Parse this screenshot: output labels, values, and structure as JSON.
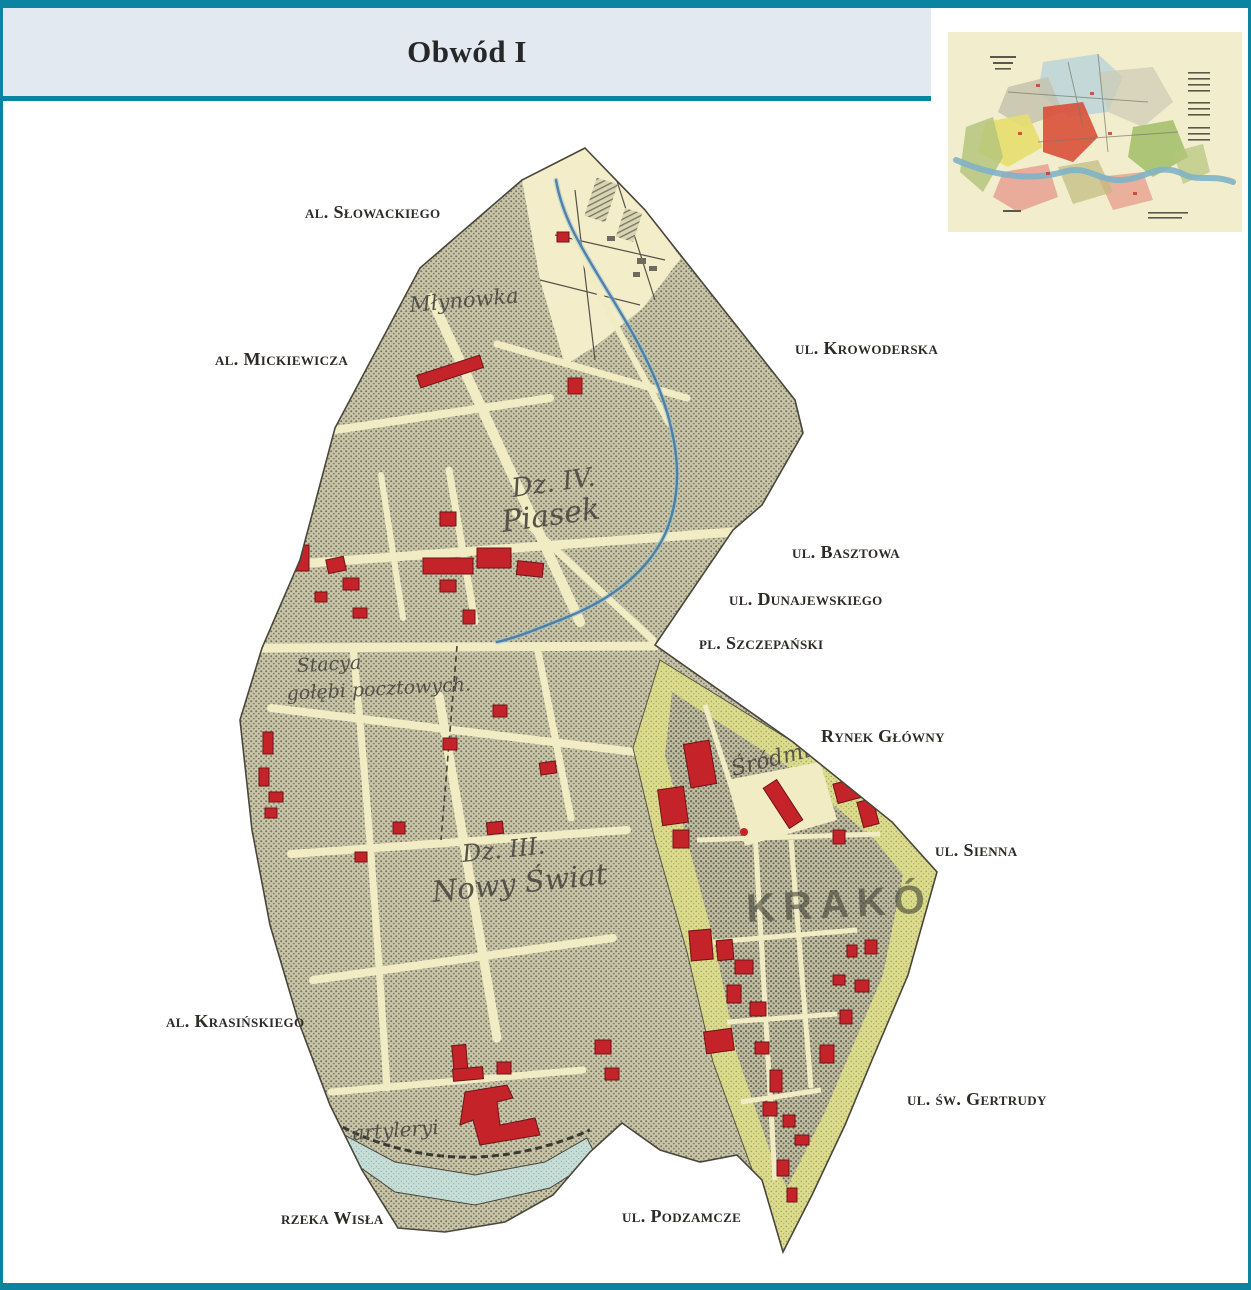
{
  "header": {
    "title": "Obwód I"
  },
  "street_labels": [
    {
      "id": "al-slowackiego",
      "text": "al. Słowackiego"
    },
    {
      "id": "al-mickiewicza",
      "text": "al. Mickiewicza"
    },
    {
      "id": "ul-krowoderska",
      "text": "ul. Krowoderska"
    },
    {
      "id": "ul-basztowa",
      "text": "ul. Basztowa"
    },
    {
      "id": "ul-dunajewskiego",
      "text": "ul. Dunajewskiego"
    },
    {
      "id": "pl-szczepanski",
      "text": "pl. Szczepański"
    },
    {
      "id": "rynek-glowny",
      "text": "Rynek Główny"
    },
    {
      "id": "ul-sienna",
      "text": "ul. Sienna"
    },
    {
      "id": "al-krasinskiego",
      "text": "al. Krasińskiego"
    },
    {
      "id": "ul-sw-gertrudy",
      "text": "ul. św. Gertrudy"
    },
    {
      "id": "ul-podzamcze",
      "text": "ul. Podzamcze"
    },
    {
      "id": "rzeka-wisla",
      "text": "rzeka Wisła"
    }
  ],
  "map_annotations": {
    "stream_name": "Młynówka",
    "district4_line1": "Dz. IV.",
    "district4_line2": "Piasek",
    "station_line1": "Stacya",
    "station_line2": "gołębi pocztowych.",
    "district3_line1": "Dz. III.",
    "district3_line2": "Nowy Świat",
    "srodmiescie": "Śródmieście",
    "city_stamp": "KRAKÓW",
    "artillery": "artyleryi"
  },
  "colors": {
    "frame_teal": "#0a84a0",
    "header_bg": "#e3e9f0",
    "map_cream": "#f2ecc5",
    "building_red": "#c32329",
    "planty_green": "#d9d88b",
    "river_blue": "#c7ded8",
    "stream_blue": "#4179a3"
  }
}
